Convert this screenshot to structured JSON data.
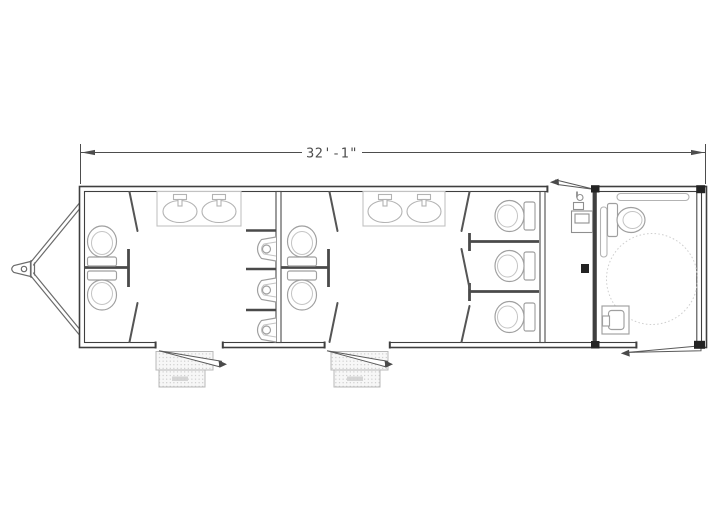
{
  "page": {
    "background": "#ffffff"
  },
  "drawing": {
    "type": "floor-plan",
    "subject": "restroom-trailer",
    "dimension": {
      "label": "32'-1\""
    },
    "palette": {
      "wall_line": "#3f3f3f",
      "partition_line": "#4a4a4a",
      "fixture_line": "#9f9f9f",
      "counter_line": "#c2c2c2",
      "turning_circle": "#cfcfcf",
      "dimension_line": "#4d4d4d",
      "step_dot": "#bdbdbd",
      "hardware_dark": "#232323",
      "background": "#ffffff"
    },
    "inventory": {
      "left_restroom": {
        "toilet_stalls": 2,
        "sinks": 2,
        "urinals": 3,
        "entry_doors": 1,
        "step_sets": 1
      },
      "center_restroom": {
        "toilet_stalls": 5,
        "sinks": 2,
        "entry_doors": 1,
        "step_sets": 1
      },
      "rear_vestibule": {
        "utility_fixtures": 1,
        "entry_doors": 1
      },
      "ada_restroom": {
        "toilets": 1,
        "sinks": 1,
        "grab_bars": 2,
        "wheelchair_turning_circles": 1,
        "entry_doors": 1
      },
      "exterior": {
        "tongue_hitch": 1,
        "door_swings": 4,
        "fold_down_steps": 2
      }
    }
  }
}
